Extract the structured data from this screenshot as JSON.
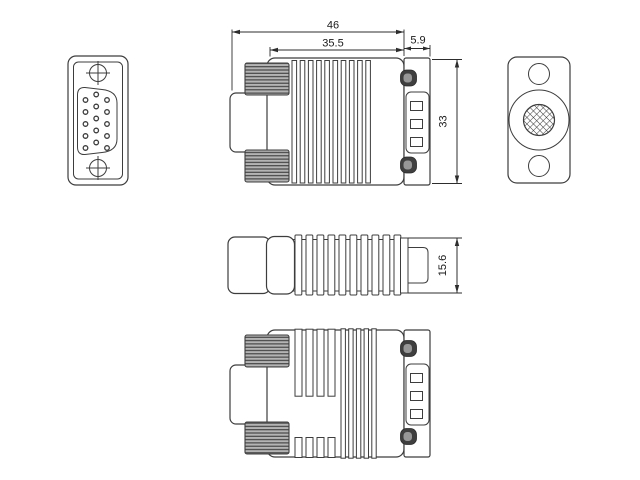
{
  "drawing_type": "technical-drawing",
  "dimensions": {
    "overall_length": "46",
    "body_length": "35.5",
    "rear_connector_length": "5.9",
    "body_width": "33",
    "body_thickness": "15.6"
  },
  "views": {
    "front_view": {
      "pin_count": 15,
      "pin_columns": 3,
      "pin_rows": 5,
      "screw_holes": 2
    },
    "side_view": {
      "rib_grooves": 10,
      "contact_slots": 3,
      "thumbscrews": 2
    },
    "rear_view": {
      "screw_holes": 2,
      "knurled_center": "crosshatched-circle"
    },
    "top_view": {
      "ribs": 10
    },
    "bottom_view": {
      "rib_grooves_long": 4,
      "rib_grooves_short": 4,
      "rib_grooves_full": 5,
      "contact_slots": 3
    }
  },
  "colors": {
    "line": "#3d3d3d",
    "dimension_line": "#2d2d2d",
    "knurl_fill": "#b4b4b4",
    "screw_head_fill": "#3f3f3f",
    "background": "#ffffff"
  }
}
